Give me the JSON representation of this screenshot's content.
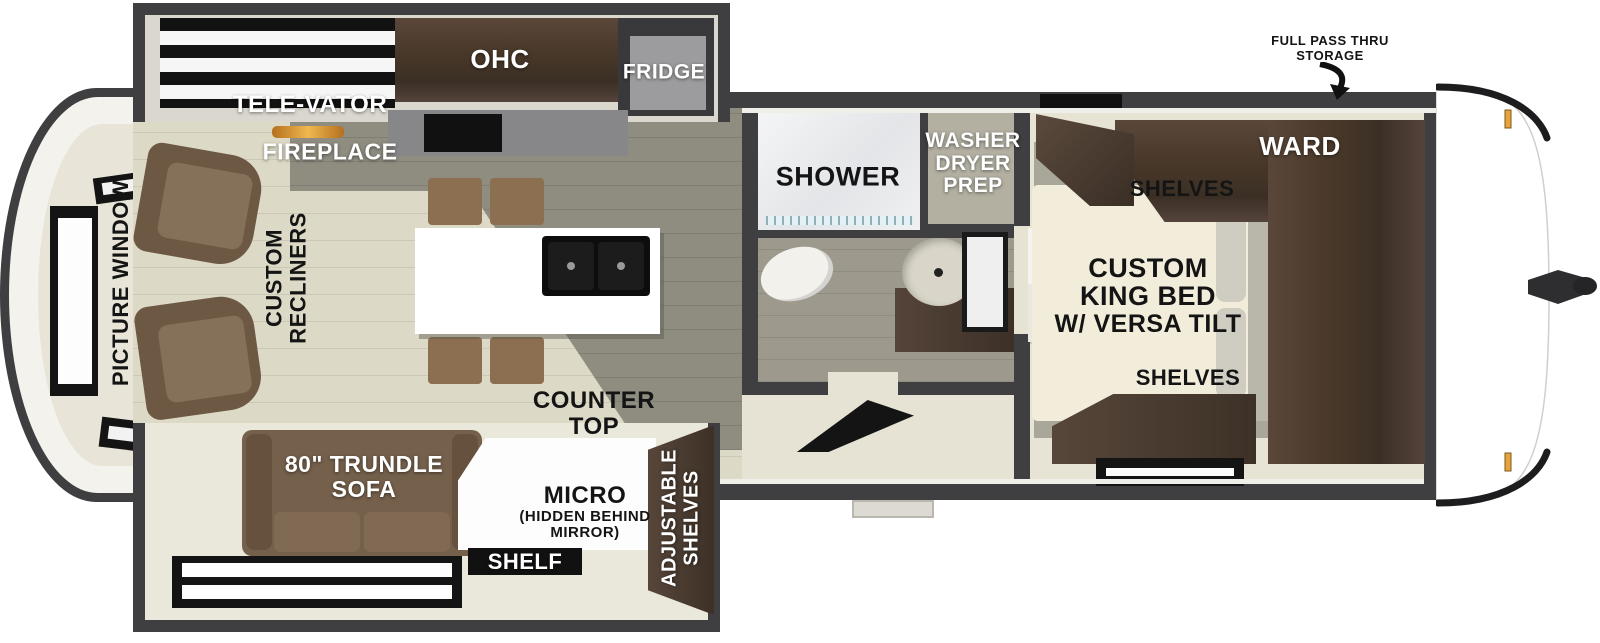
{
  "floorplan": {
    "title": "Travel trailer floor plan",
    "labels": {
      "pass_thru": {
        "line1": "FULL PASS THRU",
        "line2": "STORAGE"
      },
      "tele_vator": "TELE-VATOR",
      "ohc": "OHC",
      "fridge": "FRIDGE",
      "fireplace": "FIREPLACE",
      "picture_window": "PICTURE WINDOW",
      "recliners": {
        "line1": "CUSTOM",
        "line2": "RECLINERS"
      },
      "shower": "SHOWER",
      "washer": {
        "line1": "WASHER",
        "line2": "DRYER",
        "line3": "PREP"
      },
      "ward": "WARD",
      "shelves_top": "SHELVES",
      "king_bed": {
        "line1": "CUSTOM",
        "line2": "KING BED",
        "line3": "W/ VERSA TILT"
      },
      "shelves_bottom": "SHELVES",
      "counter_top": {
        "line1": "COUNTER",
        "line2": "TOP"
      },
      "trundle_sofa": {
        "line1": "80\" TRUNDLE",
        "line2": "SOFA"
      },
      "micro": {
        "line1": "MICRO",
        "line2": "(HIDDEN BEHIND",
        "line3": "MIRROR)"
      },
      "shelf": "SHELF",
      "adjustable_shelves": {
        "line1": "ADJUSTABLE",
        "line2": "SHELVES"
      }
    },
    "colors": {
      "wall": "#3f3f41",
      "floor_light": "#ddd9c7",
      "floor_dark": "#8f8c80",
      "slide_floor": "#eae7db",
      "bath_floor": "#9d9a8d",
      "bedroom_floor": "#a9a69a",
      "cabinet_wood": "#4d3d31",
      "sofa_brown": "#7c6550",
      "bed_cream": "#f2eddb",
      "island_white": "#ffffff",
      "sink_black": "#0d0d0d",
      "label_black": "#141414",
      "label_white": "#ffffff",
      "marker_amber": "#e8a33d",
      "fireplace_glow": "#e09a2d"
    }
  }
}
